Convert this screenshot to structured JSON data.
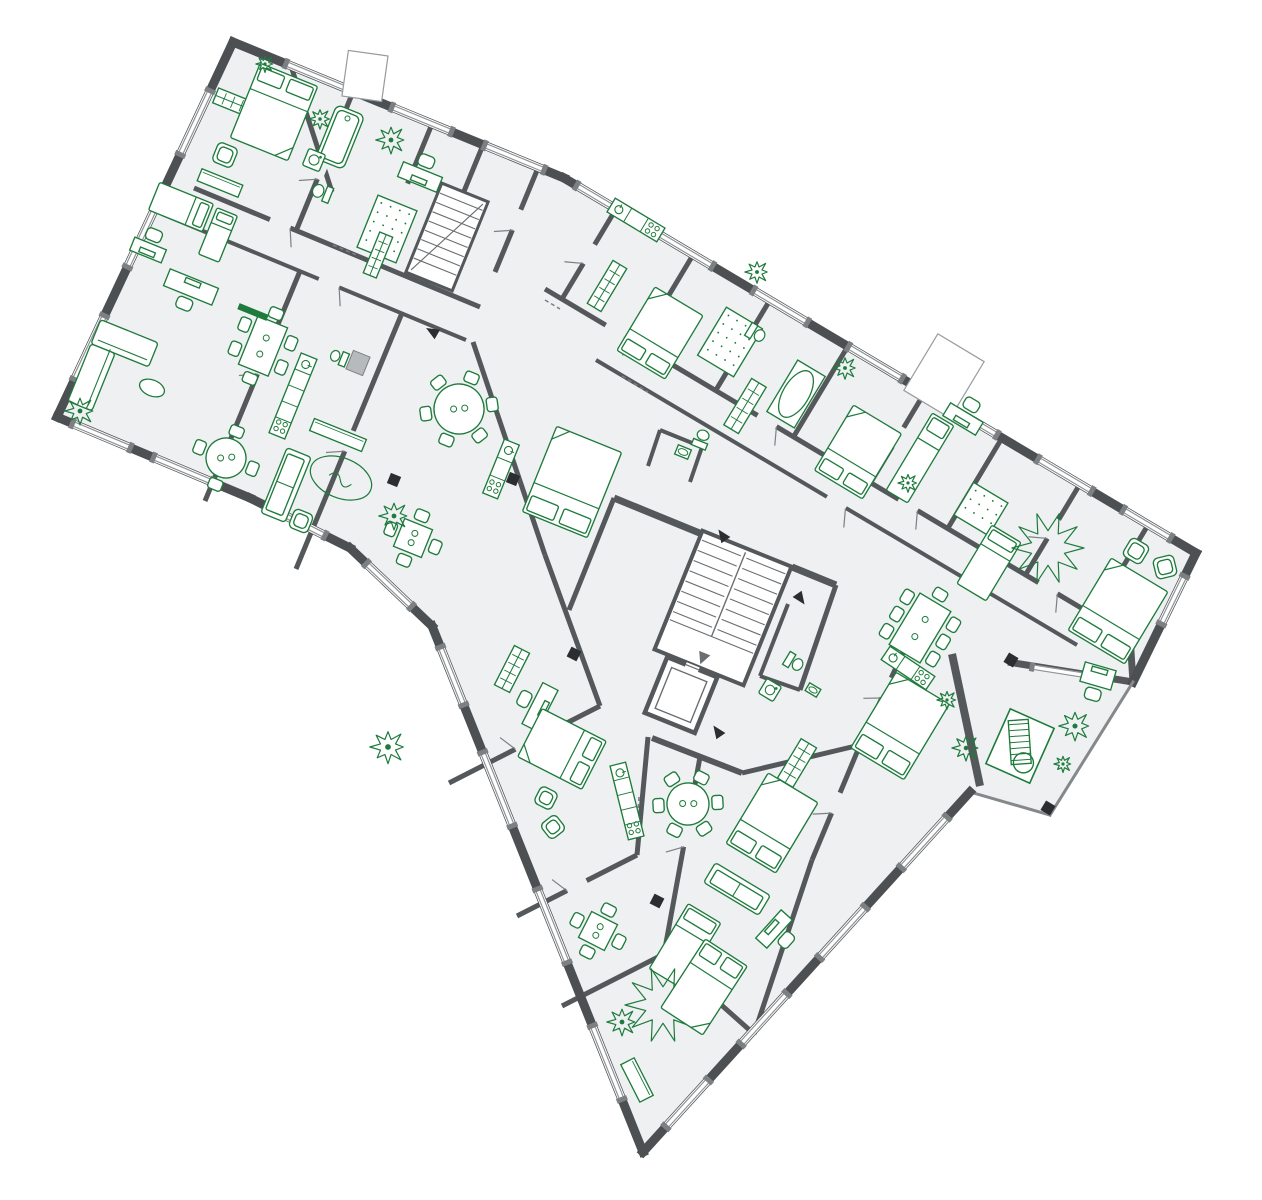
{
  "meta": {
    "type": "architectural-floor-plan",
    "description": "Rotated residential multi-apartment floor plan, dark grey walls, green furniture symbols",
    "canvas_width": 1262,
    "canvas_height": 1200
  },
  "palette": {
    "background": "#ffffff",
    "floor": "#eef0f2",
    "wall_exterior": "#4c5053",
    "wall_interior": "#54585b",
    "wall_mid": "#7c8083",
    "wall_light": "#b7babc",
    "rail": "#85898b",
    "stair": "#6a6e71",
    "window_line": "#8f9395",
    "furniture": "#1e7b3c",
    "marker": "#2b2e30"
  },
  "outline": {
    "points": [
      [
        233,
        42
      ],
      [
        564,
        178
      ],
      [
        1196,
        553
      ],
      [
        1133,
        682
      ],
      [
        1050,
        815
      ],
      [
        970,
        792
      ],
      [
        643,
        1152
      ],
      [
        432,
        626
      ],
      [
        350,
        548
      ],
      [
        250,
        498
      ],
      [
        57,
        417
      ]
    ],
    "segment_widths": [
      9,
      9,
      9,
      3,
      3,
      9,
      9,
      9,
      9,
      9,
      9
    ],
    "rail_segments": [
      3,
      4
    ]
  },
  "shafts": [
    {
      "x": 365,
      "y": 76,
      "w": 40,
      "h": 46,
      "r": 8
    },
    {
      "x": 944,
      "y": 376,
      "w": 54,
      "h": 66,
      "r": 31
    }
  ],
  "walls": [
    [
      291,
      66,
      332,
      192,
      5
    ],
    [
      353,
      92,
      296,
      231,
      5
    ],
    [
      432,
      124,
      375,
      263,
      5
    ],
    [
      483,
      145,
      426,
      284,
      5
    ],
    [
      538,
      168,
      495,
      272,
      5
    ],
    [
      194,
      188,
      480,
      307,
      5
    ],
    [
      162,
      214,
      466,
      340,
      4
    ],
    [
      300,
      271,
      205,
      501,
      5
    ],
    [
      402,
      313,
      296,
      569,
      5
    ],
    [
      473,
      342,
      545,
      555,
      5
    ],
    [
      545,
      555,
      600,
      706,
      5
    ],
    [
      614,
      498,
      569,
      610,
      5
    ],
    [
      616,
      209,
      562,
      299,
      5
    ],
    [
      693,
      255,
      639,
      345,
      5
    ],
    [
      770,
      300,
      716,
      390,
      5
    ],
    [
      848,
      346,
      794,
      436,
      5
    ],
    [
      925,
      392,
      871,
      482,
      5
    ],
    [
      1002,
      438,
      948,
      528,
      5
    ],
    [
      1080,
      484,
      1026,
      574,
      5
    ],
    [
      1148,
      525,
      1094,
      615,
      5
    ],
    [
      545,
      289,
      1130,
      637,
      5
    ],
    [
      596,
      360,
      1077,
      645,
      4
    ],
    [
      614,
      498,
      702,
      534,
      7
    ],
    [
      792,
      567,
      836,
      585,
      7
    ],
    [
      652,
      738,
      742,
      773,
      6
    ],
    [
      836,
      585,
      800,
      690,
      5
    ],
    [
      800,
      690,
      760,
      676,
      4
    ],
    [
      788,
      604,
      760,
      676,
      4
    ],
    [
      913,
      631,
      860,
      745,
      5
    ],
    [
      860,
      745,
      742,
      773,
      5
    ],
    [
      860,
      745,
      812,
      860,
      5
    ],
    [
      812,
      860,
      754,
      1034,
      5
    ],
    [
      648,
      737,
      637,
      855,
      5
    ],
    [
      700,
      757,
      664,
      954,
      5
    ],
    [
      600,
      706,
      449,
      783,
      5
    ],
    [
      637,
      855,
      517,
      916,
      5
    ],
    [
      664,
      954,
      562,
      1006,
      5
    ],
    [
      664,
      954,
      754,
      1034,
      5
    ],
    [
      660,
      430,
      702,
      447,
      4
    ],
    [
      702,
      447,
      690,
      482,
      4
    ],
    [
      660,
      430,
      648,
      466,
      4
    ],
    [
      1130,
      637,
      1133,
      682,
      7
    ],
    [
      1008,
      662,
      1133,
      682,
      7
    ],
    [
      952,
      654,
      980,
      786,
      8
    ]
  ],
  "windows": [
    {
      "seg": 0,
      "a": 0.16,
      "b": 0.36
    },
    {
      "seg": 0,
      "a": 0.48,
      "b": 0.66
    },
    {
      "seg": 0,
      "a": 0.76,
      "b": 0.94
    },
    {
      "seg": 1,
      "a": 0.02,
      "b": 0.085
    },
    {
      "seg": 1,
      "a": 0.15,
      "b": 0.235
    },
    {
      "seg": 1,
      "a": 0.3,
      "b": 0.385
    },
    {
      "seg": 1,
      "a": 0.45,
      "b": 0.535
    },
    {
      "seg": 1,
      "a": 0.6,
      "b": 0.685
    },
    {
      "seg": 1,
      "a": 0.75,
      "b": 0.835
    },
    {
      "seg": 1,
      "a": 0.885,
      "b": 0.96
    },
    {
      "seg": 2,
      "a": 0.18,
      "b": 0.55
    },
    {
      "seg": 5,
      "a": 0.07,
      "b": 0.21
    },
    {
      "seg": 5,
      "a": 0.32,
      "b": 0.46
    },
    {
      "seg": 5,
      "a": 0.56,
      "b": 0.7
    },
    {
      "seg": 5,
      "a": 0.8,
      "b": 0.93
    },
    {
      "seg": 6,
      "a": 0.1,
      "b": 0.24
    },
    {
      "seg": 6,
      "a": 0.36,
      "b": 0.5
    },
    {
      "seg": 6,
      "a": 0.62,
      "b": 0.76
    },
    {
      "seg": 6,
      "a": 0.85,
      "b": 0.96
    },
    {
      "seg": 7,
      "a": 0.25,
      "b": 0.8
    },
    {
      "seg": 8,
      "a": 0.25,
      "b": 0.78
    },
    {
      "seg": 9,
      "a": 0.2,
      "b": 0.5
    },
    {
      "seg": 9,
      "a": 0.62,
      "b": 0.92
    },
    {
      "seg": 10,
      "a": 0.1,
      "b": 0.27
    },
    {
      "seg": 10,
      "a": 0.4,
      "b": 0.57
    },
    {
      "seg": 10,
      "a": 0.7,
      "b": 0.87
    }
  ],
  "free_windows": [
    [
      1032,
      667,
      1108,
      679,
      7
    ]
  ],
  "doors": [
    [
      322,
      169,
      112
    ],
    [
      404,
      194,
      112
    ],
    [
      517,
      220,
      112
    ],
    [
      280,
      224,
      23
    ],
    [
      329,
      283,
      23
    ],
    [
      615,
      331,
      31
    ],
    [
      767,
      421,
      31
    ],
    [
      908,
      505,
      31
    ],
    [
      1048,
      588,
      31
    ],
    [
      836,
      503,
      31
    ],
    [
      589,
      254,
      121
    ],
    [
      743,
      345,
      121
    ],
    [
      898,
      437,
      121
    ],
    [
      1053,
      529,
      121
    ],
    [
      686,
      836,
      100
    ],
    [
      525,
      744,
      153
    ],
    [
      577,
      886,
      153
    ],
    [
      887,
      688,
      115
    ],
    [
      836,
      803,
      113
    ],
    [
      262,
      364,
      112
    ],
    [
      349,
      441,
      112
    ]
  ],
  "dashes": [
    [
      333,
      245,
      359,
      256
    ],
    [
      622,
      376,
      648,
      392
    ],
    [
      639,
      797,
      637,
      824
    ],
    [
      545,
      300,
      560,
      309
    ]
  ],
  "markers": [
    [
      394,
      480,
      22
    ],
    [
      513,
      479,
      22
    ],
    [
      574,
      654,
      27
    ],
    [
      657,
      901,
      27
    ],
    [
      1011,
      660,
      31
    ],
    [
      1048,
      808,
      31
    ]
  ],
  "arrows": [
    [
      433,
      332,
      210
    ],
    [
      723,
      536,
      235
    ],
    [
      800,
      598,
      55
    ],
    [
      718,
      732,
      235
    ]
  ],
  "stairs": {
    "main": {
      "x": 723,
      "y": 608,
      "w": 96,
      "h": 128,
      "r": 22
    },
    "secondary": {
      "x": 447,
      "y": 237,
      "w": 50,
      "h": 96,
      "r": 22
    },
    "elevator": {
      "x": 681,
      "y": 695,
      "w": 54,
      "h": 60,
      "r": 22
    }
  },
  "furniture": [
    {
      "t": "wardrobe",
      "x": 237,
      "y": 104,
      "w": 46,
      "h": 16,
      "r": 22
    },
    {
      "t": "bed_double",
      "x": 274,
      "y": 112,
      "w": 62,
      "h": 80,
      "r": 22
    },
    {
      "t": "armchair",
      "x": 225,
      "y": 155,
      "w": 21,
      "h": 21,
      "r": 22
    },
    {
      "t": "sideboard",
      "x": 220,
      "y": 183,
      "w": 44,
      "h": 13,
      "r": 22
    },
    {
      "t": "tub",
      "x": 340,
      "y": 137,
      "w": 30,
      "h": 58,
      "r": 22
    },
    {
      "t": "washer",
      "x": 314,
      "y": 160,
      "w": 18,
      "h": 18,
      "r": 22
    },
    {
      "t": "toilet",
      "x": 321,
      "y": 192,
      "w": 16,
      "h": 21,
      "r": 112
    },
    {
      "t": "plant",
      "x": 391,
      "y": 140,
      "rr": 15
    },
    {
      "t": "plant",
      "x": 320,
      "y": 119,
      "rr": 11
    },
    {
      "t": "plant",
      "x": 265,
      "y": 64,
      "rr": 9
    },
    {
      "t": "desk",
      "x": 420,
      "y": 177,
      "w": 42,
      "h": 16,
      "r": 202
    },
    {
      "t": "rug_dotted",
      "x": 387,
      "y": 229,
      "w": 42,
      "h": 56,
      "r": 22
    },
    {
      "t": "wardrobe",
      "x": 378,
      "y": 255,
      "w": 44,
      "h": 14,
      "r": 112
    },
    {
      "t": "bed_single",
      "x": 181,
      "y": 207,
      "w": 30,
      "h": 58,
      "r": 112
    },
    {
      "t": "bed_single",
      "x": 218,
      "y": 235,
      "w": 22,
      "h": 50,
      "r": 22
    },
    {
      "t": "desk",
      "x": 191,
      "y": 287,
      "w": 52,
      "h": 18,
      "r": 22
    },
    {
      "t": "sofa_l",
      "x": 113,
      "y": 372,
      "w": 62,
      "h": 88,
      "r": 22
    },
    {
      "t": "table_oval",
      "x": 152,
      "y": 388,
      "w": 26,
      "h": 16,
      "r": 22
    },
    {
      "t": "plant",
      "x": 80,
      "y": 411,
      "rr": 15
    },
    {
      "t": "table_round",
      "x": 226,
      "y": 458,
      "rr": 20,
      "s": 4,
      "r": 22
    },
    {
      "t": "desk",
      "x": 148,
      "y": 250,
      "w": 34,
      "h": 14,
      "r": 202
    },
    {
      "t": "table_rect",
      "x": 263,
      "y": 346,
      "w": 32,
      "h": 52,
      "r": 22,
      "s": 6
    },
    {
      "t": "tv",
      "x": 253,
      "y": 312,
      "w": 30,
      "h": 5,
      "r": 22
    },
    {
      "t": "kitchen",
      "x": 293,
      "y": 396,
      "w": 86,
      "h": 17,
      "r": 112
    },
    {
      "t": "gray_box",
      "x": 358,
      "y": 363,
      "w": 18,
      "h": 20,
      "r": 22
    },
    {
      "t": "toilet",
      "x": 338,
      "y": 357,
      "w": 14,
      "h": 19,
      "r": 112
    },
    {
      "t": "sideboard",
      "x": 338,
      "y": 435,
      "w": 56,
      "h": 13,
      "r": 22
    },
    {
      "t": "sofa",
      "x": 286,
      "y": 485,
      "w": 70,
      "h": 26,
      "r": 112
    },
    {
      "t": "rug_oval",
      "x": 341,
      "y": 478,
      "w": 64,
      "h": 40,
      "r": 22
    },
    {
      "t": "armchair",
      "x": 301,
      "y": 521,
      "w": 20,
      "h": 20,
      "r": 112
    },
    {
      "t": "table_rect",
      "x": 413,
      "y": 538,
      "w": 30,
      "h": 30,
      "r": 22,
      "s": 4
    },
    {
      "t": "plant",
      "x": 394,
      "y": 516,
      "rr": 15
    },
    {
      "t": "table_round",
      "x": 459,
      "y": 409,
      "rr": 25,
      "s": 6,
      "r": 22
    },
    {
      "t": "kitchen",
      "x": 501,
      "y": 469,
      "w": 58,
      "h": 16,
      "r": 112
    },
    {
      "t": "bed_double",
      "x": 572,
      "y": 482,
      "w": 70,
      "h": 92,
      "r": 202
    },
    {
      "t": "toilet",
      "x": 702,
      "y": 438,
      "w": 15,
      "h": 20,
      "r": 202
    },
    {
      "t": "sink",
      "x": 683,
      "y": 452,
      "w": 14,
      "h": 10,
      "r": 202
    },
    {
      "t": "kitchen",
      "x": 636,
      "y": 220,
      "w": 58,
      "h": 16,
      "r": 31
    },
    {
      "t": "wardrobe",
      "x": 607,
      "y": 286,
      "w": 50,
      "h": 16,
      "r": 121
    },
    {
      "t": "plant",
      "x": 757,
      "y": 272,
      "rr": 12
    },
    {
      "t": "rug_dotted",
      "x": 730,
      "y": 342,
      "w": 42,
      "h": 56,
      "r": 31
    },
    {
      "t": "bed_double",
      "x": 660,
      "y": 333,
      "w": 56,
      "h": 74,
      "r": 211
    },
    {
      "t": "tub_oval",
      "x": 796,
      "y": 394,
      "w": 32,
      "h": 60,
      "r": 31
    },
    {
      "t": "toilet",
      "x": 757,
      "y": 334,
      "w": 15,
      "h": 20,
      "r": 301
    },
    {
      "t": "wardrobe",
      "x": 745,
      "y": 406,
      "w": 54,
      "h": 17,
      "r": 121
    },
    {
      "t": "bed_double",
      "x": 858,
      "y": 452,
      "w": 56,
      "h": 76,
      "r": 211
    },
    {
      "t": "plant",
      "x": 845,
      "y": 368,
      "rr": 12
    },
    {
      "t": "bed_single",
      "x": 920,
      "y": 458,
      "w": 25,
      "h": 90,
      "r": 31
    },
    {
      "t": "desk",
      "x": 963,
      "y": 419,
      "w": 38,
      "h": 15,
      "r": 211
    },
    {
      "t": "plant",
      "x": 908,
      "y": 483,
      "rr": 10
    },
    {
      "t": "rug_dotted",
      "x": 981,
      "y": 509,
      "w": 40,
      "h": 38,
      "r": 31
    },
    {
      "t": "bed_single",
      "x": 989,
      "y": 563,
      "w": 34,
      "h": 68,
      "r": 31
    },
    {
      "t": "rug_star",
      "x": 1048,
      "y": 548,
      "rr": 36
    },
    {
      "t": "desk",
      "x": 1098,
      "y": 676,
      "w": 32,
      "h": 20,
      "r": 16
    },
    {
      "t": "armchair",
      "x": 1136,
      "y": 551,
      "w": 21,
      "h": 21,
      "r": 31
    },
    {
      "t": "armchair",
      "x": 1165,
      "y": 567,
      "w": 21,
      "h": 21,
      "r": 76
    },
    {
      "t": "bed_double",
      "x": 1118,
      "y": 611,
      "w": 66,
      "h": 84,
      "r": 211
    },
    {
      "t": "table_rect",
      "x": 920,
      "y": 628,
      "w": 36,
      "h": 60,
      "r": 31,
      "s": 8
    },
    {
      "t": "kitchen",
      "x": 908,
      "y": 668,
      "w": 54,
      "h": 16,
      "r": 34
    },
    {
      "t": "toilet",
      "x": 795,
      "y": 663,
      "w": 15,
      "h": 20,
      "r": 301
    },
    {
      "t": "sink",
      "x": 813,
      "y": 690,
      "w": 13,
      "h": 9,
      "r": 211
    },
    {
      "t": "washer",
      "x": 770,
      "y": 690,
      "w": 17,
      "h": 17,
      "r": 31
    },
    {
      "t": "bed_double",
      "x": 900,
      "y": 726,
      "w": 62,
      "h": 88,
      "r": 211
    },
    {
      "t": "wardrobe",
      "x": 797,
      "y": 763,
      "w": 46,
      "h": 18,
      "r": 121
    },
    {
      "t": "bed_double",
      "x": 772,
      "y": 823,
      "w": 58,
      "h": 82,
      "r": 211
    },
    {
      "t": "sofa",
      "x": 737,
      "y": 889,
      "w": 64,
      "h": 23,
      "r": 31
    },
    {
      "t": "bed_single",
      "x": 685,
      "y": 946,
      "w": 38,
      "h": 76,
      "r": 31
    },
    {
      "t": "deck_stair",
      "x": 1020,
      "y": 746,
      "w": 48,
      "h": 60,
      "r": 24
    },
    {
      "t": "plant",
      "x": 966,
      "y": 748,
      "rr": 14
    },
    {
      "t": "plant",
      "x": 1075,
      "y": 726,
      "rr": 16
    },
    {
      "t": "plant",
      "x": 1063,
      "y": 764,
      "rr": 9
    },
    {
      "t": "plant",
      "x": 947,
      "y": 700,
      "rr": 10
    },
    {
      "t": "desk",
      "x": 540,
      "y": 707,
      "w": 46,
      "h": 17,
      "r": 117
    },
    {
      "t": "bed_double",
      "x": 562,
      "y": 749,
      "w": 54,
      "h": 72,
      "r": 117
    },
    {
      "t": "kitchen",
      "x": 627,
      "y": 801,
      "w": 76,
      "h": 16,
      "r": 76
    },
    {
      "t": "wardrobe",
      "x": 512,
      "y": 669,
      "w": 44,
      "h": 17,
      "r": 117
    },
    {
      "t": "armchair",
      "x": 546,
      "y": 798,
      "w": 19,
      "h": 19,
      "r": 27
    },
    {
      "t": "armchair",
      "x": 553,
      "y": 827,
      "w": 19,
      "h": 19,
      "r": 52
    },
    {
      "t": "plant",
      "x": 388,
      "y": 747,
      "rr": 18
    },
    {
      "t": "table_rect",
      "x": 598,
      "y": 931,
      "w": 29,
      "h": 29,
      "r": 27,
      "s": 4
    },
    {
      "t": "plant",
      "x": 622,
      "y": 1022,
      "rr": 15
    },
    {
      "t": "rug_star",
      "x": 663,
      "y": 1005,
      "rr": 38
    },
    {
      "t": "bed_double",
      "x": 704,
      "y": 987,
      "w": 50,
      "h": 82,
      "r": 33
    },
    {
      "t": "desk",
      "x": 774,
      "y": 929,
      "w": 38,
      "h": 15,
      "r": 312
    },
    {
      "t": "sideboard",
      "x": 637,
      "y": 1080,
      "w": 42,
      "h": 15,
      "r": 63
    },
    {
      "t": "table_round",
      "x": 688,
      "y": 804,
      "rr": 21,
      "s": 6,
      "r": 27
    }
  ]
}
